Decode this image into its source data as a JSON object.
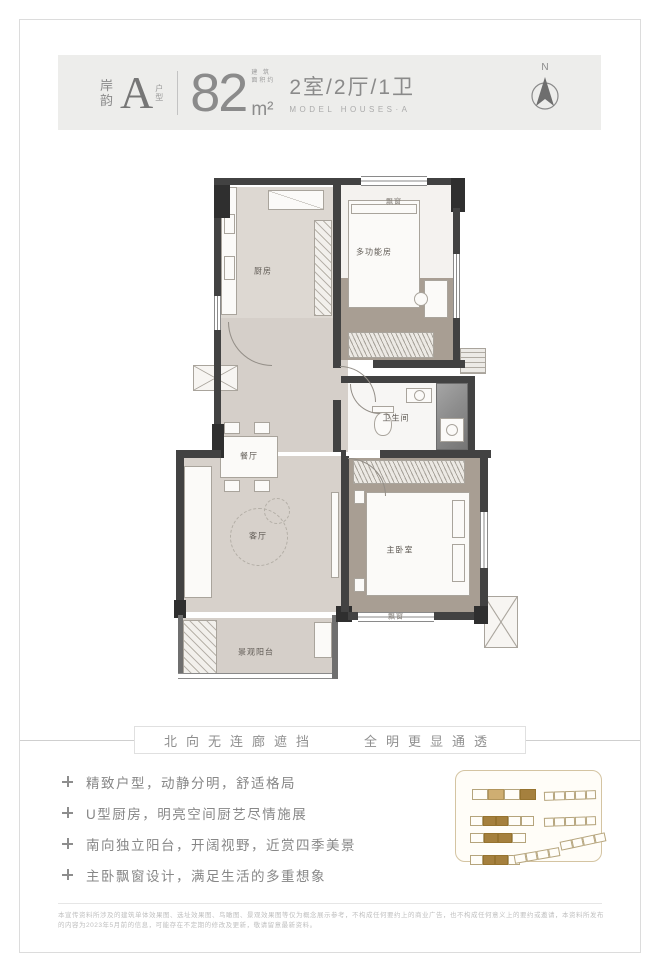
{
  "header": {
    "series_top": "岸",
    "series_bottom": "韵",
    "type_letter": "A",
    "type_label_top": "户",
    "type_label_bottom": "型",
    "area_value": "82",
    "area_unit": "m²",
    "area_note_line1": "建 筑",
    "area_note_line2": "面积约",
    "layout_text": "2室/2厅/1卫",
    "layout_sub": "MODEL HOUSES·A",
    "compass_label": "N"
  },
  "floor_plan": {
    "labels": {
      "bay_top": "飘窗",
      "kitchen": "厨房",
      "bedroom2": "多功能房",
      "bathroom": "卫生间",
      "dining": "餐厅",
      "living": "客厅",
      "master": "主卧室",
      "bay_bottom": "飘窗",
      "balcony": "景观阳台"
    }
  },
  "slogan": {
    "left": "北向无连廊遮挡",
    "right": "全明更显通透"
  },
  "features": [
    "精致户型，动静分明，舒适格局",
    "U型厨房，明亮空间厨艺尽情施展",
    "南向独立阳台，开阔视野，近赏四季美景",
    "主卧飘窗设计，满足生活的多重想象"
  ],
  "site_map": {
    "bars": [
      {
        "x": 16,
        "y": 18,
        "w": 64,
        "h": 11,
        "rot": 0,
        "cells": [
          "o",
          "l",
          "o",
          "f"
        ]
      },
      {
        "x": 88,
        "y": 20,
        "w": 52,
        "h": 9,
        "rot": -2,
        "cells": [
          "o",
          "o",
          "o",
          "o",
          "o"
        ]
      },
      {
        "x": 14,
        "y": 45,
        "w": 64,
        "h": 10,
        "rot": 0,
        "cells": [
          "o",
          "f",
          "f",
          "o",
          "o"
        ]
      },
      {
        "x": 88,
        "y": 46,
        "w": 52,
        "h": 9,
        "rot": -2,
        "cells": [
          "o",
          "o",
          "o",
          "o",
          "o"
        ]
      },
      {
        "x": 14,
        "y": 62,
        "w": 56,
        "h": 10,
        "rot": 0,
        "cells": [
          "o",
          "f",
          "f",
          "o"
        ]
      },
      {
        "x": 14,
        "y": 84,
        "w": 50,
        "h": 10,
        "rot": 0,
        "cells": [
          "o",
          "f",
          "f",
          "o"
        ]
      },
      {
        "x": 58,
        "y": 80,
        "w": 46,
        "h": 9,
        "rot": -10,
        "cells": [
          "o",
          "o",
          "o",
          "o"
        ]
      },
      {
        "x": 104,
        "y": 66,
        "w": 46,
        "h": 9,
        "rot": -12,
        "cells": [
          "o",
          "o",
          "o",
          "o"
        ]
      }
    ]
  },
  "disclaimer": "本宣传资料所涉及的建筑单体效果图、选址效果图、鸟瞰图、景观效果图等仅为概念展示参考，不构成任何要约上的商业广告，也不构成任何意义上的要约或邀请，本资料所发布的内容为2023年5月前的信息，可能存在不定期的修改及更新，敬请留意最新资料。"
}
